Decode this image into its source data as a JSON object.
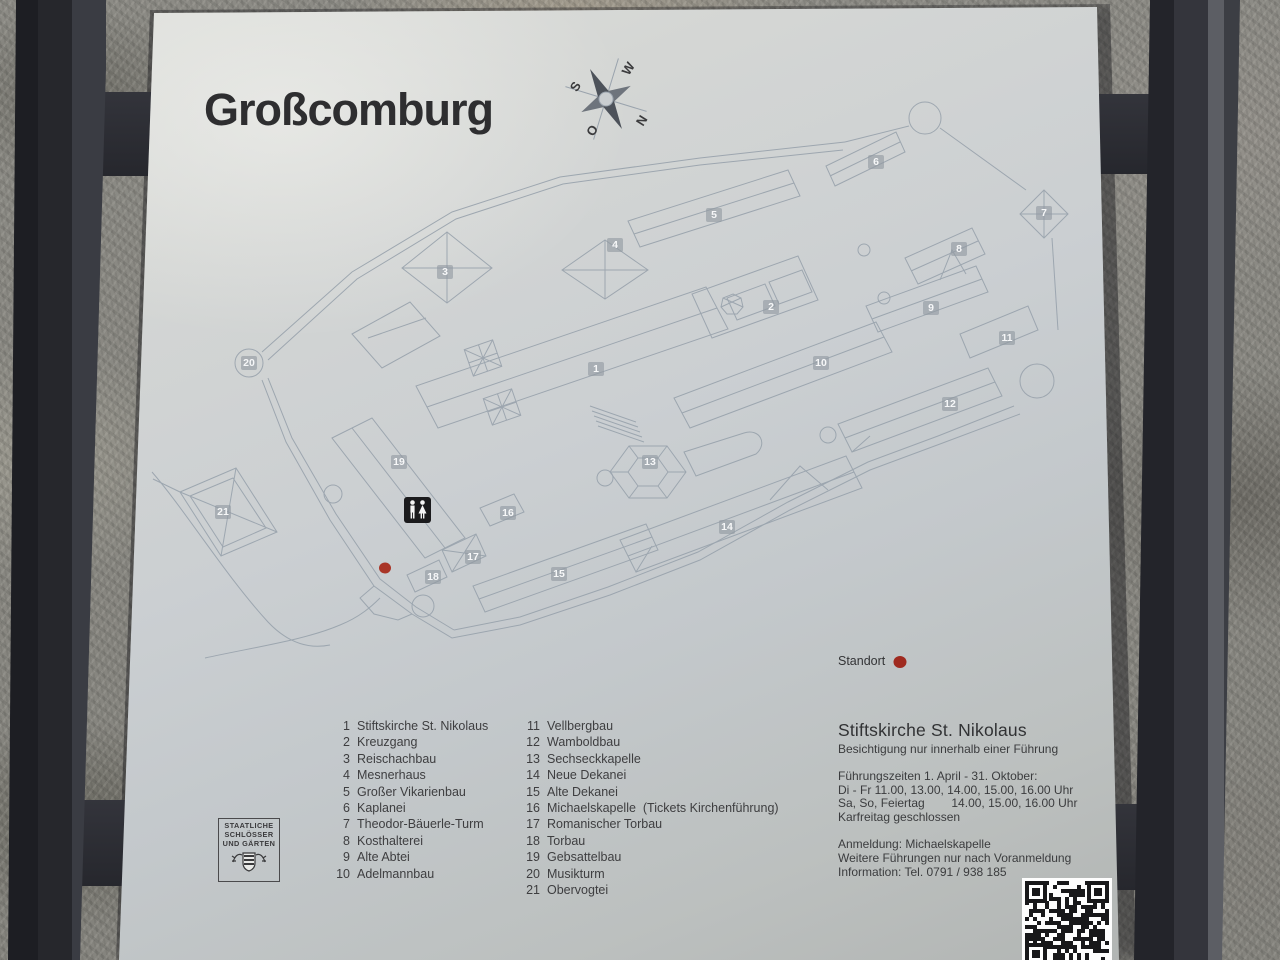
{
  "panel": {
    "title": "Großcomburg",
    "compass": {
      "top_left": "S",
      "top_right": "W",
      "bottom_left": "O",
      "bottom_right": "N"
    },
    "standort_label": "Standort",
    "colors": {
      "accent_red": "#9f2a1f",
      "panel_gray": "#cbcfd2",
      "map_line": "#98a2ac",
      "post_dark": "#26272c"
    },
    "icons": [
      "compass-rose",
      "wc-icon",
      "qr-code",
      "coat-of-arms"
    ]
  },
  "map": {
    "badges": [
      {
        "num": "1"
      },
      {
        "num": "2"
      },
      {
        "num": "3"
      },
      {
        "num": "4"
      },
      {
        "num": "5"
      },
      {
        "num": "6"
      },
      {
        "num": "7"
      },
      {
        "num": "8"
      },
      {
        "num": "9"
      },
      {
        "num": "10"
      },
      {
        "num": "11"
      },
      {
        "num": "12"
      },
      {
        "num": "13"
      },
      {
        "num": "14"
      },
      {
        "num": "15"
      },
      {
        "num": "16"
      },
      {
        "num": "17"
      },
      {
        "num": "18"
      },
      {
        "num": "19"
      },
      {
        "num": "20"
      },
      {
        "num": "21"
      }
    ]
  },
  "legend": {
    "col1": [
      {
        "num": "1",
        "label": "Stiftskirche St. Nikolaus"
      },
      {
        "num": "2",
        "label": "Kreuzgang"
      },
      {
        "num": "3",
        "label": "Reischachbau"
      },
      {
        "num": "4",
        "label": "Mesnerhaus"
      },
      {
        "num": "5",
        "label": "Großer Vikarienbau"
      },
      {
        "num": "6",
        "label": "Kaplanei"
      },
      {
        "num": "7",
        "label": "Theodor-Bäuerle-Turm"
      },
      {
        "num": "8",
        "label": "Kosthalterei"
      },
      {
        "num": "9",
        "label": "Alte Abtei"
      },
      {
        "num": "10",
        "label": "Adelmannbau"
      }
    ],
    "col2": [
      {
        "num": "11",
        "label": "Vellbergbau"
      },
      {
        "num": "12",
        "label": "Wamboldbau"
      },
      {
        "num": "13",
        "label": "Sechseckkapelle"
      },
      {
        "num": "14",
        "label": "Neue Dekanei"
      },
      {
        "num": "15",
        "label": "Alte Dekanei"
      },
      {
        "num": "16",
        "label": "Michaelskapelle  (Tickets Kirchenführung)"
      },
      {
        "num": "17",
        "label": "Romanischer Torbau"
      },
      {
        "num": "18",
        "label": "Torbau"
      },
      {
        "num": "19",
        "label": "Gebsattelbau"
      },
      {
        "num": "20",
        "label": "Musikturm"
      },
      {
        "num": "21",
        "label": "Obervogtei"
      }
    ]
  },
  "info": {
    "heading": "Stiftskirche St. Nikolaus",
    "subheading": "Besichtigung nur innerhalb einer Führung",
    "line1": "Führungszeiten 1. April - 31. Oktober:",
    "line2": "Di - Fr 11.00, 13.00, 14.00, 15.00, 16.00 Uhr",
    "line3": "Sa, So, Feiertag        14.00, 15.00, 16.00 Uhr",
    "line4": "Karfreitag geschlossen",
    "line5": "Anmeldung: Michaelskapelle",
    "line6": "Weitere Führungen nur nach Voranmeldung",
    "line7": "Information: Tel. 0791 / 938 185"
  },
  "logo": {
    "line1": "STAATLICHE",
    "line2": "SCHLÖSSER",
    "line3": "UND GÄRTEN"
  }
}
